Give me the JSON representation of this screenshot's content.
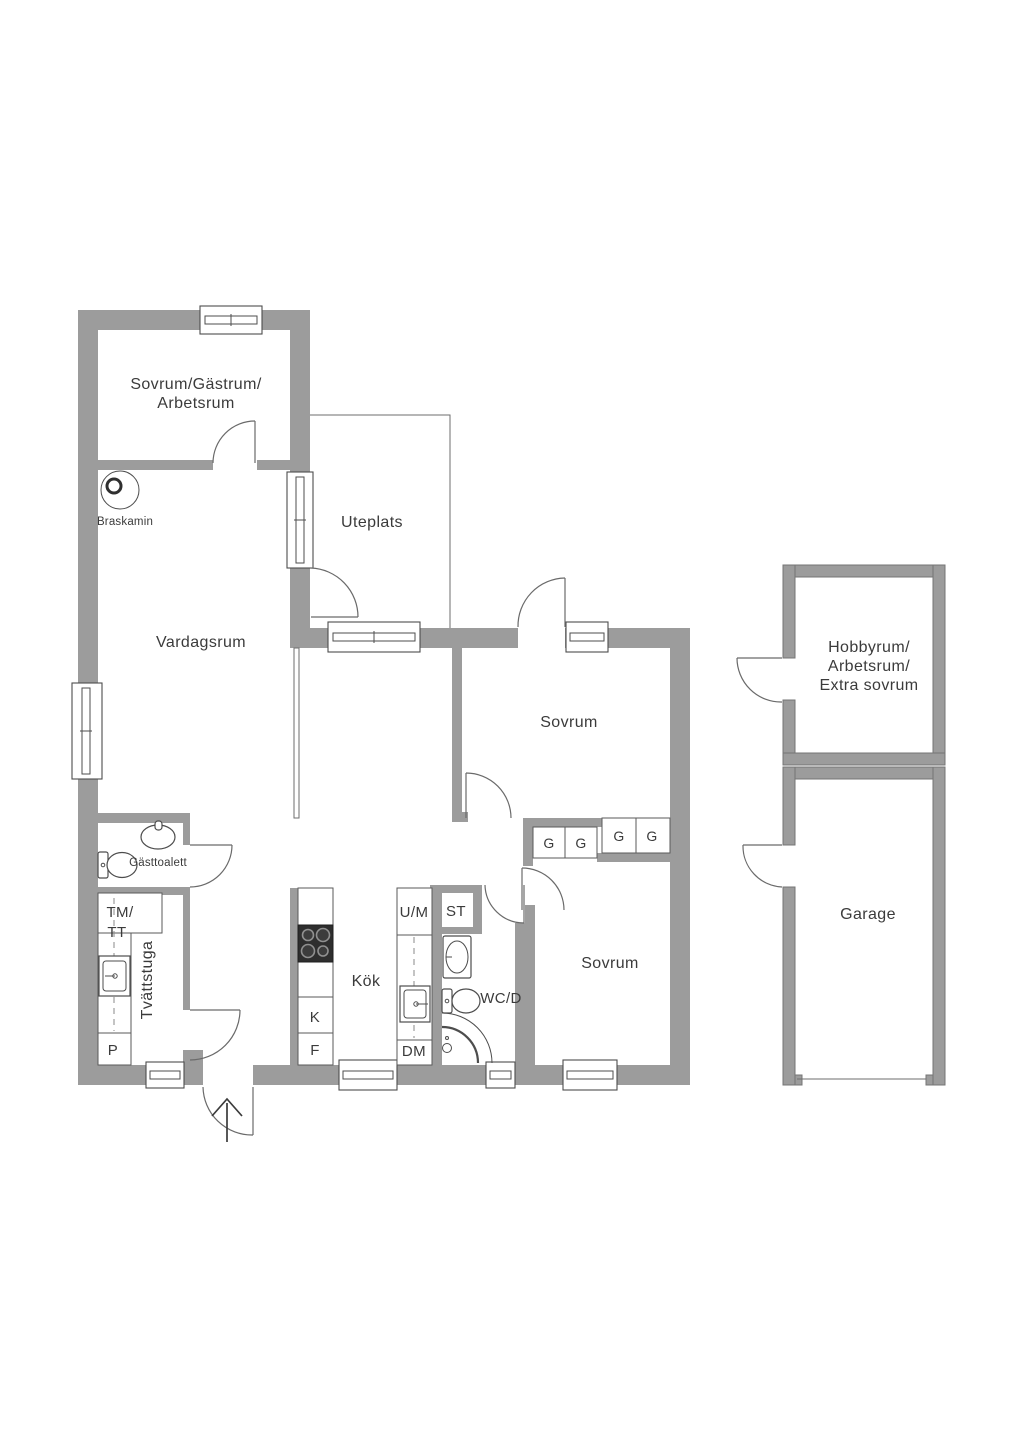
{
  "rooms": {
    "guest_bedroom": {
      "line1": "Sovrum/Gästrum/",
      "line2": "Arbetsrum"
    },
    "patio": {
      "label": "Uteplats"
    },
    "living_room": {
      "label": "Vardagsrum"
    },
    "bedroom_upper": {
      "label": "Sovrum"
    },
    "bedroom_lower": {
      "label": "Sovrum"
    },
    "kitchen": {
      "label": "Kök"
    },
    "laundry": {
      "label": "Tvättstuga"
    },
    "guest_wc": {
      "label": "Gästtoalett"
    },
    "shower_wc": {
      "label": "WC/D"
    },
    "hobby_room": {
      "line1": "Hobbyrum/",
      "line2": "Arbetsrum/",
      "line3": "Extra sovrum"
    },
    "garage": {
      "label": "Garage"
    }
  },
  "features": {
    "fireplace": {
      "label": "Braskamin"
    }
  },
  "appliances": {
    "washer_dryer_line1": "TM/",
    "washer_dryer_line2": "TT",
    "pantry": "P",
    "fridge": "K",
    "freezer": "F",
    "oven_microwave": "U/M",
    "dishwasher": "DM",
    "cleaning_closet": "ST",
    "wardrobe": "G"
  },
  "colors": {
    "wall": "#9c9c9c",
    "line": "#4d4d4d",
    "text": "#3b3b3b",
    "background": "#ffffff"
  }
}
